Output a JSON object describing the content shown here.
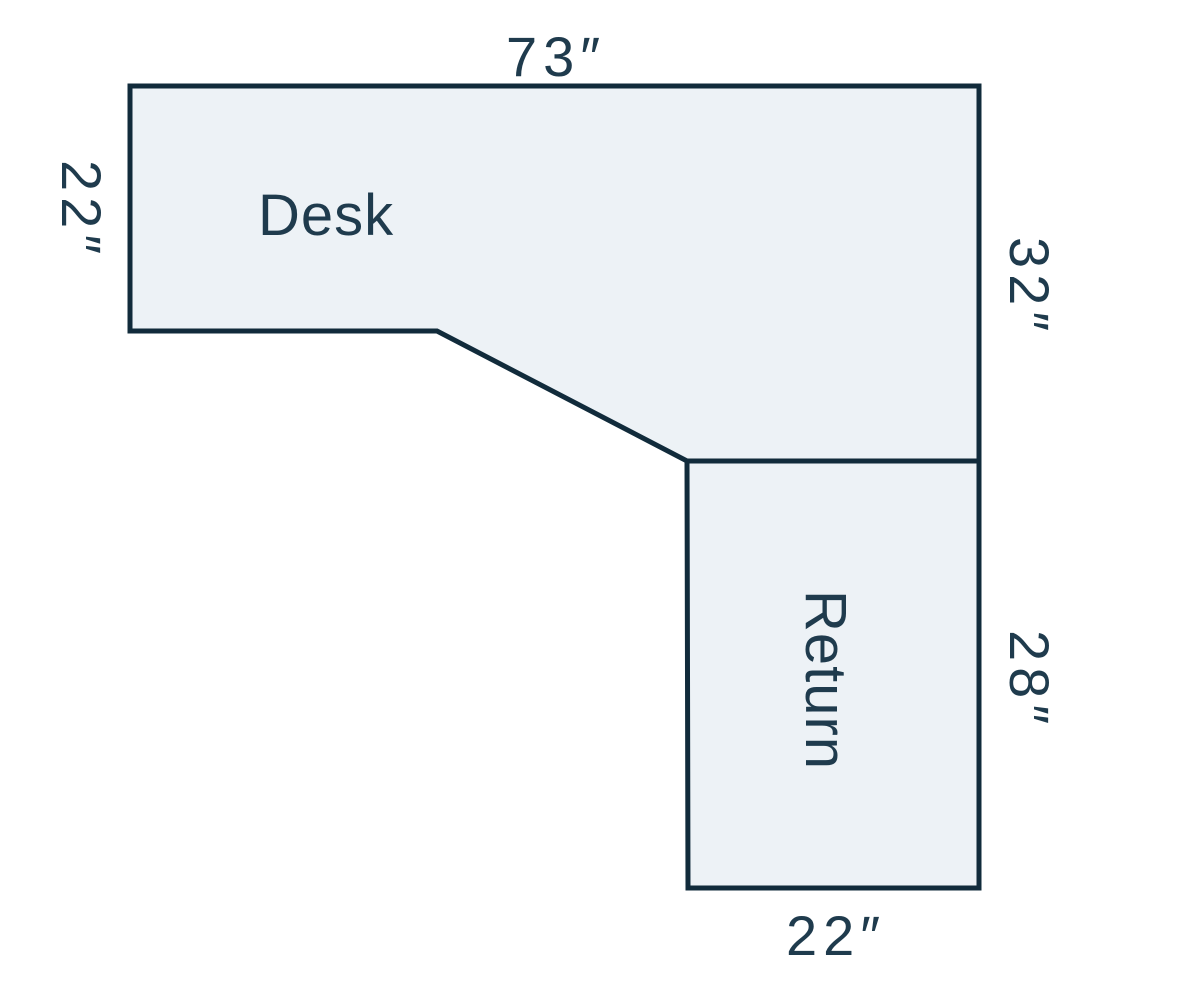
{
  "diagram": {
    "desk": {
      "label": "Desk",
      "top_dim": "73″",
      "left_dim": "22″",
      "right_dim": "32″"
    },
    "return_part": {
      "label": "Return",
      "right_dim": "28″",
      "bottom_dim": "22″"
    }
  },
  "colors": {
    "background": "#ffffff",
    "fill": "#edf2f6",
    "stroke": "#112b3b",
    "text": "#1f3b4d"
  }
}
